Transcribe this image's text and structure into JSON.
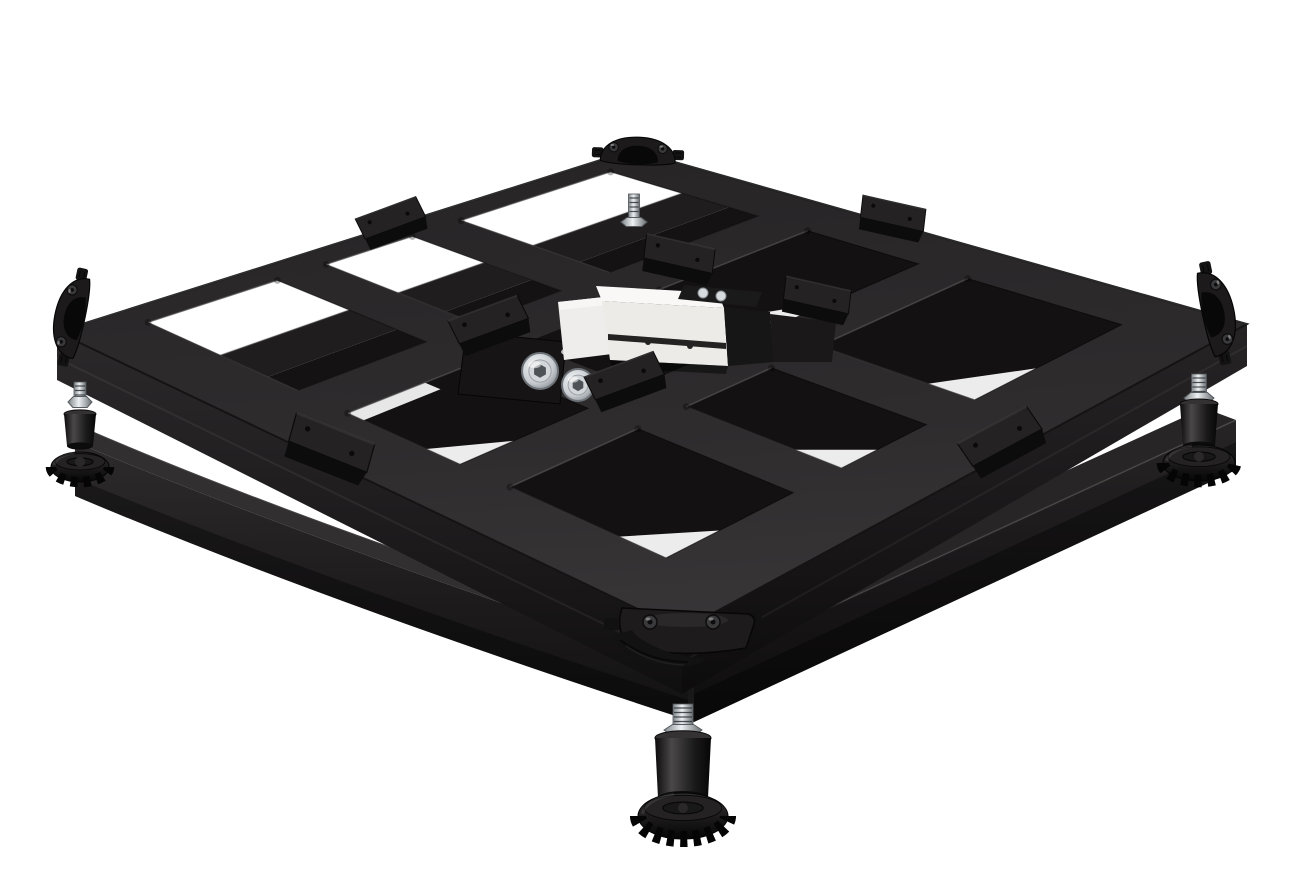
{
  "image": {
    "kind": "product-photograph",
    "subject": "Industrial platform scale base frame with center load cell, rubber support pads, corner bumpers and adjustable leveling feet",
    "background_color": "#ffffff"
  },
  "colors": {
    "background": "#ffffff",
    "frame_top_light": "#3a3839",
    "frame_top_dark": "#272526",
    "frame_side_light": "#2a2829",
    "frame_side_deep": "#0e0d0d",
    "cell_dark": "#131112",
    "under_beam": "#1f1d1e",
    "under_beam_shadow": "#141213",
    "base_rail_light": "#312f30",
    "base_rail_dark": "#121111",
    "pad_top": "#242223",
    "pad_front": "#0d0c0c",
    "bumper_body": "#1c1a1b",
    "bumper_dark": "#080808",
    "loadcell_top": "#f9f8f7",
    "loadcell_front": "#edebe8",
    "loadcell_left": "#eeedeb",
    "loadcell_slot": "#242322",
    "plate_black": "#1b1a1a",
    "metal_light": "#eef1f3",
    "metal_mid": "#7d8387",
    "metal_dark": "#4e5357",
    "foot_body_mid": "#4a4848",
    "foot_body_dark": "#0c0b0b",
    "disc_top": "#242223",
    "disc_dark": "#070606"
  },
  "parts": {
    "platform_frame": {
      "label": "welded steel platform grid frame",
      "openings_visible": 8
    },
    "base_frame": {
      "label": "lower base frame rails",
      "rails_visible": 2
    },
    "load_cell": {
      "label": "single-point load cell at center",
      "mounting_bolts_visible": 2
    },
    "rubber_pads": {
      "label": "rubber support pads on beams",
      "count_visible": 8
    },
    "corner_bumpers": {
      "label": "rubber corner bumpers",
      "count_visible": 4
    },
    "leveling_feet": {
      "label": "adjustable knurled leveling feet",
      "feet_visible": 3,
      "threaded_rods_visible": 4
    }
  }
}
